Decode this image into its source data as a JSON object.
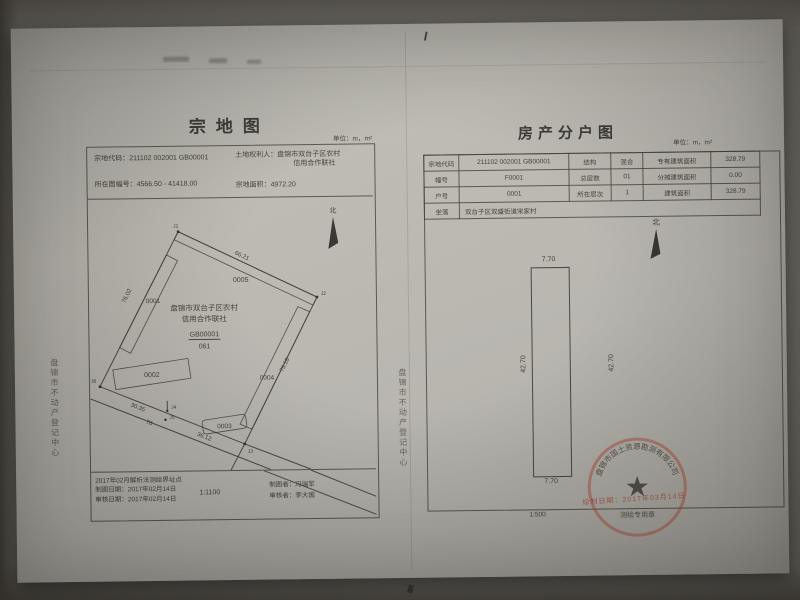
{
  "side_text": {
    "left_vertical": "盘锦市不动产登记中心",
    "middle_vertical": "盘锦市不动产登记中心"
  },
  "parcel_map": {
    "title": "宗地图",
    "unit": "单位：m，m²",
    "header": {
      "parcel_code_label": "宗地代码：",
      "parcel_code_value": "211102 002001 GB00001",
      "holder_label": "土地权利人：",
      "holder_line1": "盘锦市双台子区农村",
      "holder_line2": "信用合作联社",
      "sheet_label": "所在图幅号：",
      "sheet_value": "4566.50 - 41418.00",
      "area_label": "宗地面积：",
      "area_value": "4972.20"
    },
    "drawing": {
      "north_label": "北",
      "center_line1": "盘锦市双台子区农村",
      "center_line2": "信用合作联社",
      "center_code": "GB00001",
      "center_code_sub": "061",
      "b1": "0001",
      "b2": "0002",
      "b3": "0003",
      "b4": "0004",
      "b5": "0005",
      "j1": "J1",
      "j2": "J2",
      "j3": "J3",
      "j4": "J4",
      "j5": "J5",
      "j6": "J6",
      "dim_top": "66.21",
      "dim_left": "76.02",
      "dim_right": "73.18",
      "dim_bottom": "30.35",
      "dim_road": "76",
      "dim_b3": "36.12"
    },
    "footer": {
      "note1": "2017年02月解析法测绘界址点",
      "note2": "制图日期：2017年02月14日",
      "note3": "审核日期：2017年02月14日",
      "scale": "1:1100",
      "drafter": "制图者：冯瑞军",
      "reviewer": "审核者：李大国"
    }
  },
  "unit_map": {
    "title": "房产分户图",
    "unit": "单位：m，m²",
    "table": {
      "rows": [
        {
          "c1": "宗地代码",
          "c2": "211102 002001 GB00001",
          "c3": "结构",
          "c4": "混合",
          "c5": "专有建筑面积",
          "c6": "328.79"
        },
        {
          "c1": "幢号",
          "c2": "F0001",
          "c3": "总层数",
          "c4": "01",
          "c5": "分摊建筑面积",
          "c6": "0.00"
        },
        {
          "c1": "户号",
          "c2": "0001",
          "c3": "所在层次",
          "c4": "1",
          "c5": "建筑面积",
          "c6": "328.79"
        },
        {
          "c1": "坐落",
          "c2": "双台子区双盛街道宋家村"
        }
      ]
    },
    "drawing": {
      "north_label": "北",
      "dim_top": "7.70",
      "dim_bottom": "7.70",
      "dim_left": "42.70",
      "dim_right": "42.70"
    },
    "scale": "1:500"
  },
  "stamps": {
    "seal_arc": "盘锦市国土资源勘测有限公司",
    "seal_title": "测绘专用章",
    "date": "绘制日期：2017年03月14日"
  }
}
